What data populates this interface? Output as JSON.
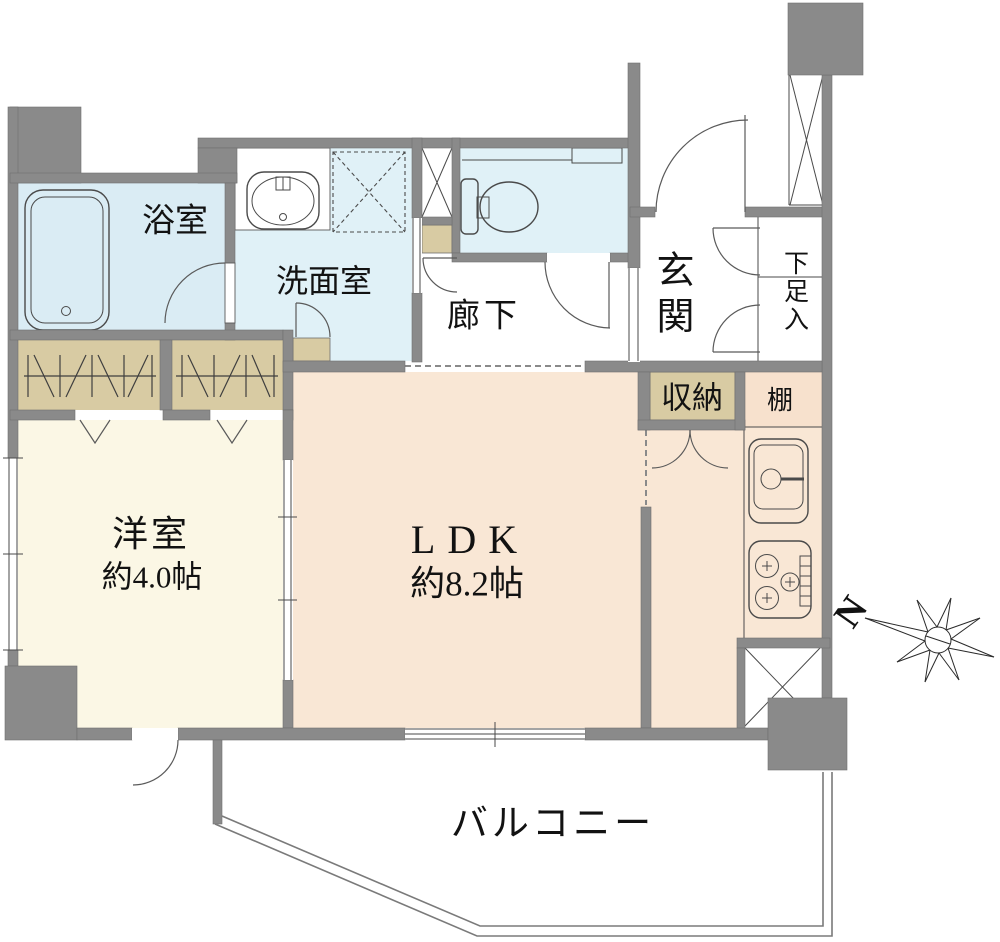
{
  "rooms": {
    "bathroom": {
      "label": "浴室"
    },
    "washroom": {
      "label": "洗面室"
    },
    "hallway": {
      "label": "廊下"
    },
    "entrance": {
      "label": "玄関"
    },
    "shoe_cabinet": {
      "label": "下足入"
    },
    "storage": {
      "label": "収納"
    },
    "shelf": {
      "label": "棚"
    },
    "western_room": {
      "label": "洋室",
      "size": "約4.0帖"
    },
    "ldk": {
      "label": "LDK",
      "size": "約8.2帖"
    },
    "balcony": {
      "label": "バルコニー"
    }
  },
  "compass": {
    "north_label": "N"
  },
  "colors": {
    "wall": "#8a8a8a",
    "wet_room_blue": "#e0f1f7",
    "bathroom_blue": "#daecf4",
    "closet_beige": "#d8cba3",
    "ldk_pink": "#f9e7d5",
    "shelf_pink": "#f7e1cd",
    "bedroom_cream": "#fbf7e5",
    "fixture_line": "#4a4a4a",
    "text": "#121212"
  }
}
